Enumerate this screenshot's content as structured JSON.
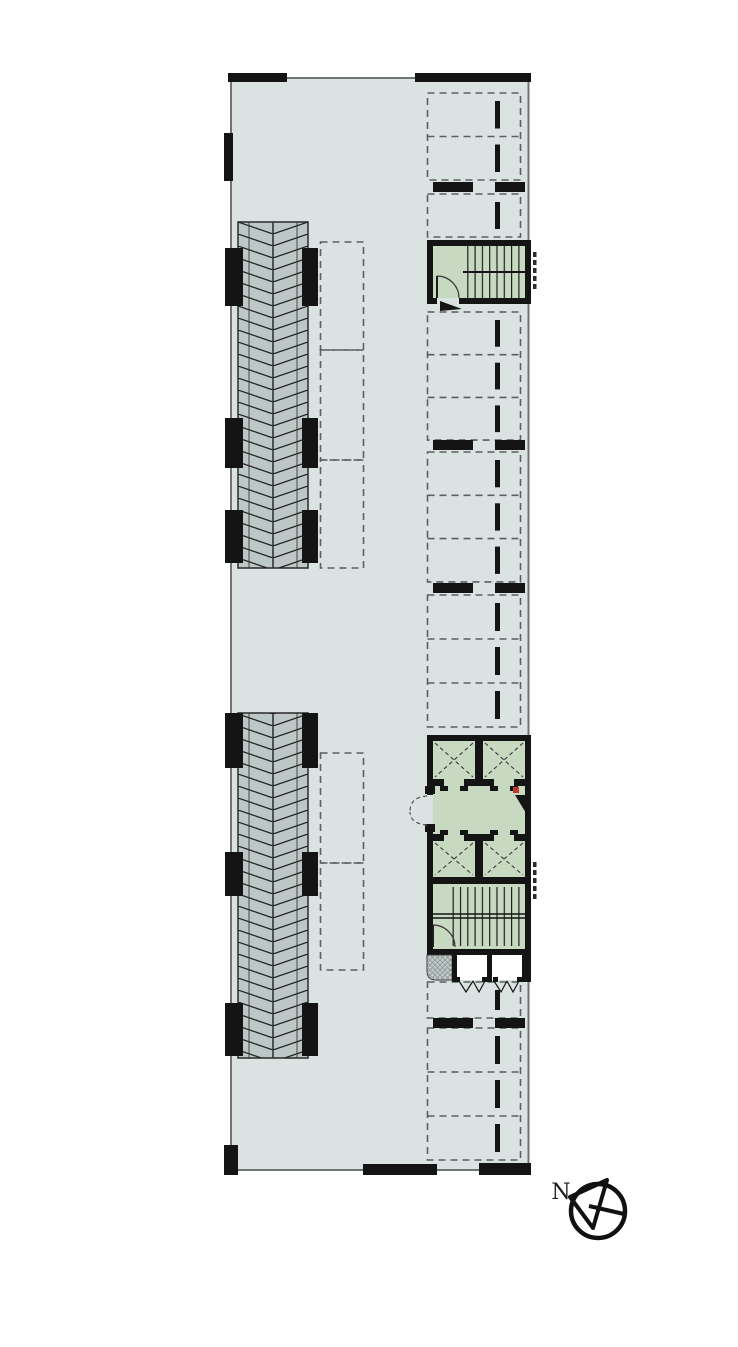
{
  "compass": {
    "label": "N"
  },
  "colors": {
    "background": "#ffffff",
    "floor": "#dae3e2",
    "core_green": "#c8d9c1",
    "ramp_gray": "#bcc7c6",
    "wall_black": "#141414",
    "outline_gray": "#6f7575",
    "dash_gray": "#5b6060",
    "hatch_fill": "#c2cbca",
    "accent_red": "#c0392b",
    "hatch_line": "#232323"
  },
  "plan": {
    "parking": {
      "x": 427.5,
      "width": 93,
      "tick_x": 495,
      "tick_width": 5,
      "tick_inset": 8,
      "groups": [
        {
          "top": 93,
          "count": 2,
          "stall_h": 43.5
        },
        {
          "top": 194,
          "count": 1,
          "stall_h": 43
        },
        {
          "top": 312,
          "count": 3,
          "stall_h": 42.7
        },
        {
          "top": 452,
          "count": 3,
          "stall_h": 43.3
        },
        {
          "top": 595,
          "count": 3,
          "stall_h": 44
        },
        {
          "top": 982,
          "count": 1,
          "stall_h": 36
        },
        {
          "top": 1028,
          "count": 3,
          "stall_h": 44
        }
      ],
      "pillar_rows": [
        182,
        440,
        583,
        1018
      ]
    },
    "ramps": {
      "x": 238,
      "width": 70,
      "segments": [
        {
          "top": 222,
          "height": 346
        },
        {
          "top": 713,
          "height": 345
        }
      ],
      "pillars": [
        [
          248,
          58
        ],
        [
          418,
          50
        ],
        [
          510,
          53
        ],
        [
          713,
          55
        ],
        [
          852,
          44
        ],
        [
          1003,
          53
        ]
      ]
    },
    "storage": {
      "x": 320.5,
      "width": 43,
      "cells": [
        [
          242,
          108
        ],
        [
          350,
          110
        ],
        [
          460,
          108
        ],
        [
          753,
          110
        ],
        [
          863,
          107
        ]
      ]
    }
  }
}
